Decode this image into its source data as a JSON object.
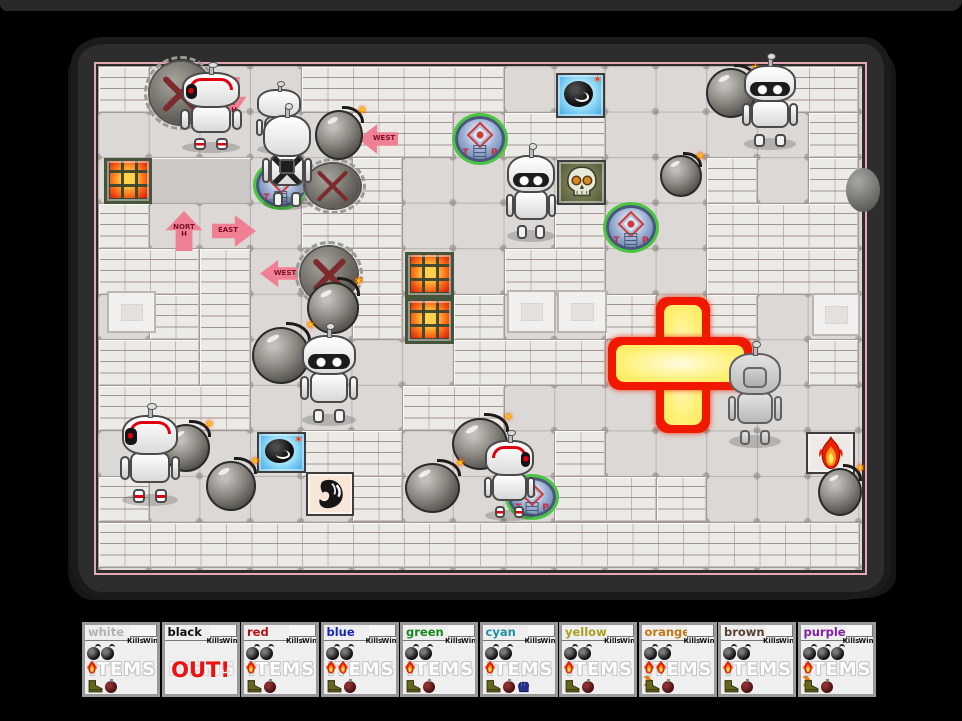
{
  "scoreboard": {
    "kills_label": "Kills",
    "wins_label": "Wins",
    "items_label": "ITEMS",
    "out_label": "OUT!",
    "players": [
      {
        "name": "white",
        "color": "#b2b2b2",
        "alive": true,
        "bombs": 2,
        "flames": 1,
        "arrow": false,
        "glove": false
      },
      {
        "name": "black",
        "color": "#101010",
        "alive": false,
        "bombs": 0,
        "flames": 0,
        "arrow": false,
        "glove": false
      },
      {
        "name": "red",
        "color": "#b61010",
        "alive": true,
        "bombs": 2,
        "flames": 1,
        "arrow": false,
        "glove": false
      },
      {
        "name": "blue",
        "color": "#1a28b8",
        "alive": true,
        "bombs": 2,
        "flames": 2,
        "arrow": false,
        "glove": false
      },
      {
        "name": "green",
        "color": "#18871f",
        "alive": true,
        "bombs": 2,
        "flames": 1,
        "arrow": false,
        "glove": false
      },
      {
        "name": "cyan",
        "color": "#2090a8",
        "alive": true,
        "bombs": 2,
        "flames": 1,
        "arrow": false,
        "glove": true
      },
      {
        "name": "yellow",
        "color": "#a8a020",
        "alive": true,
        "bombs": 2,
        "flames": 1,
        "arrow": false,
        "glove": false
      },
      {
        "name": "orange",
        "color": "#c07818",
        "alive": true,
        "bombs": 2,
        "flames": 2,
        "arrow": true,
        "glove": false
      },
      {
        "name": "brown",
        "color": "#5a4030",
        "alive": true,
        "bombs": 2,
        "flames": 1,
        "arrow": false,
        "glove": false
      },
      {
        "name": "purple",
        "color": "#8020a0",
        "alive": true,
        "bombs": 3,
        "flames": 1,
        "arrow": true,
        "glove": false
      }
    ]
  },
  "arena": {
    "colors": {
      "background": "#000000",
      "frame": "#2d2d2d",
      "border_line": "#e2a9b3",
      "floor": "#dbd8d5",
      "wall": "#eceae7",
      "explosion_rim": "#f01800",
      "explosion_core": "#fff176",
      "teleporter": "#8fa7cc",
      "arrow": "#ef8093",
      "lava": "#ff7a1a",
      "accent_red": "#e00010"
    },
    "grid": {
      "tile_w": 50.7,
      "tile_h": 45.55,
      "cols": 15,
      "rows": 11
    },
    "icons": {
      "spark": "✶"
    },
    "teleporter_letters": {
      "left": "T",
      "right": "P"
    },
    "walls": [
      {
        "c": 0,
        "r": 0,
        "w": 1,
        "h": 1
      },
      {
        "c": 4,
        "r": 0,
        "w": 4,
        "h": 1
      },
      {
        "c": 13,
        "r": 0,
        "w": 2,
        "h": 1
      },
      {
        "c": 5,
        "r": 1,
        "w": 2,
        "h": 1
      },
      {
        "c": 8,
        "r": 1,
        "w": 2,
        "h": 1
      },
      {
        "c": 14,
        "r": 1,
        "w": 1,
        "h": 1
      },
      {
        "c": 1,
        "r": 2,
        "w": 2,
        "h": 1,
        "v": "flat"
      },
      {
        "c": 5,
        "r": 2,
        "w": 1,
        "h": 1
      },
      {
        "c": 12,
        "r": 2,
        "w": 1,
        "h": 1
      },
      {
        "c": 14,
        "r": 2,
        "w": 1,
        "h": 1
      },
      {
        "c": 0,
        "r": 3,
        "w": 1,
        "h": 1
      },
      {
        "c": 4,
        "r": 3,
        "w": 2,
        "h": 1
      },
      {
        "c": 9,
        "r": 3,
        "w": 1,
        "h": 1
      },
      {
        "c": 12,
        "r": 3,
        "w": 3,
        "h": 1
      },
      {
        "c": 0,
        "r": 4,
        "w": 2,
        "h": 1
      },
      {
        "c": 2,
        "r": 4,
        "w": 1,
        "h": 3
      },
      {
        "c": 5,
        "r": 4,
        "w": 1,
        "h": 1
      },
      {
        "c": 8,
        "r": 4,
        "w": 2,
        "h": 1
      },
      {
        "c": 12,
        "r": 4,
        "w": 3,
        "h": 1
      },
      {
        "c": 1,
        "r": 5,
        "w": 1,
        "h": 1
      },
      {
        "c": 5,
        "r": 5,
        "w": 1,
        "h": 1
      },
      {
        "c": 7,
        "r": 5,
        "w": 1,
        "h": 1
      },
      {
        "c": 10,
        "r": 5,
        "w": 1,
        "h": 1
      },
      {
        "c": 12,
        "r": 5,
        "w": 1,
        "h": 1
      },
      {
        "c": 0,
        "r": 6,
        "w": 2,
        "h": 1
      },
      {
        "c": 7,
        "r": 6,
        "w": 3,
        "h": 1
      },
      {
        "c": 14,
        "r": 6,
        "w": 1,
        "h": 1
      },
      {
        "c": 0,
        "r": 7,
        "w": 3,
        "h": 1
      },
      {
        "c": 6,
        "r": 7,
        "w": 2,
        "h": 1
      },
      {
        "c": 4,
        "r": 8,
        "w": 2,
        "h": 1
      },
      {
        "c": 9,
        "r": 8,
        "w": 1,
        "h": 1
      },
      {
        "c": 0,
        "r": 9,
        "w": 1,
        "h": 1
      },
      {
        "c": 5,
        "r": 9,
        "w": 1,
        "h": 1
      },
      {
        "c": 9,
        "r": 9,
        "w": 2,
        "h": 1
      },
      {
        "c": 11,
        "r": 9,
        "w": 1,
        "h": 1
      },
      {
        "c": 0,
        "r": 10,
        "w": 15,
        "h": 1
      }
    ],
    "plates": [
      {
        "x": 9,
        "y": 225,
        "w": 49,
        "h": 42
      },
      {
        "x": 409,
        "y": 224,
        "w": 49,
        "h": 43
      },
      {
        "x": 459,
        "y": 224,
        "w": 50,
        "h": 43
      },
      {
        "x": 714,
        "y": 227,
        "w": 48,
        "h": 43
      }
    ],
    "items": [
      {
        "type": "lava-grate",
        "x": 6,
        "y": 92,
        "w": 48,
        "h": 46
      },
      {
        "type": "lava-grate",
        "x": 307,
        "y": 186,
        "w": 49,
        "h": 46
      },
      {
        "type": "lava-grate",
        "x": 307,
        "y": 232,
        "w": 49,
        "h": 46
      },
      {
        "type": "bomb-item-tile",
        "x": 458,
        "y": 7,
        "w": 49,
        "h": 45
      },
      {
        "type": "skull-item-tile",
        "x": 459,
        "y": 94,
        "w": 49,
        "h": 45
      },
      {
        "type": "bomb-item-tile",
        "x": 159,
        "y": 366,
        "w": 49,
        "h": 41
      },
      {
        "type": "swirl-item-tile",
        "x": 208,
        "y": 406,
        "w": 48,
        "h": 44
      },
      {
        "type": "flame-item-tile",
        "x": 708,
        "y": 366,
        "w": 49,
        "h": 42
      }
    ],
    "teleporters": [
      {
        "x": 158,
        "y": 97,
        "w": 50,
        "h": 44
      },
      {
        "x": 357,
        "y": 50,
        "w": 50,
        "h": 46
      },
      {
        "x": 508,
        "y": 139,
        "w": 50,
        "h": 45
      },
      {
        "x": 410,
        "y": 411,
        "w": 48,
        "h": 40
      }
    ],
    "arrows": [
      {
        "dir": "down",
        "label": "SOUTH",
        "x": 122,
        "y": 11,
        "w": 28,
        "h": 38
      },
      {
        "dir": "left",
        "label": "WEST",
        "x": 260,
        "y": 56,
        "w": 40,
        "h": 34
      },
      {
        "dir": "up",
        "label": "NORTH",
        "x": 65,
        "y": 145,
        "w": 42,
        "h": 40
      },
      {
        "dir": "right",
        "label": "EAST",
        "x": 114,
        "y": 147,
        "w": 44,
        "h": 36
      },
      {
        "dir": "left",
        "label": "WEST",
        "x": 162,
        "y": 192,
        "w": 38,
        "h": 31
      }
    ],
    "mines": [
      {
        "x": 52,
        "y": -4,
        "w": 62,
        "h": 62
      },
      {
        "x": 208,
        "y": 98,
        "w": 54,
        "h": 44
      },
      {
        "x": 203,
        "y": 181,
        "w": 56,
        "h": 55
      }
    ],
    "bombs": [
      {
        "x": 217,
        "y": 44,
        "w": 48,
        "h": 50
      },
      {
        "x": 562,
        "y": 89,
        "w": 42,
        "h": 42
      },
      {
        "x": 608,
        "y": 2,
        "w": 50,
        "h": 50
      },
      {
        "x": 64,
        "y": 358,
        "w": 48,
        "h": 48
      },
      {
        "x": 108,
        "y": 395,
        "w": 50,
        "h": 50
      },
      {
        "x": 209,
        "y": 216,
        "w": 52,
        "h": 52
      },
      {
        "x": 154,
        "y": 261,
        "w": 58,
        "h": 57
      },
      {
        "x": 354,
        "y": 352,
        "w": 56,
        "h": 52
      },
      {
        "x": 307,
        "y": 397,
        "w": 55,
        "h": 50
      },
      {
        "x": 720,
        "y": 402,
        "w": 44,
        "h": 48
      }
    ],
    "robots": [
      {
        "variant": "side-left",
        "x": 80,
        "y": 2,
        "w": 66,
        "h": 85
      },
      {
        "variant": "back",
        "x": 156,
        "y": 20,
        "w": 50,
        "h": 68
      },
      {
        "variant": "backpack",
        "x": 162,
        "y": 44,
        "w": 54,
        "h": 100
      },
      {
        "variant": "front",
        "x": 406,
        "y": 84,
        "w": 54,
        "h": 92
      },
      {
        "variant": "front",
        "x": 642,
        "y": -6,
        "w": 60,
        "h": 90
      },
      {
        "variant": "front",
        "x": 200,
        "y": 264,
        "w": 62,
        "h": 96
      },
      {
        "variant": "gray",
        "x": 628,
        "y": 282,
        "w": 58,
        "h": 100
      },
      {
        "variant": "side-left",
        "x": 20,
        "y": 344,
        "w": 64,
        "h": 96
      },
      {
        "variant": "side-right",
        "x": 384,
        "y": 370,
        "w": 55,
        "h": 85
      }
    ],
    "explosion": {
      "vertical": {
        "x": 558,
        "y": 231,
        "w": 54,
        "h": 136
      },
      "horizontal": {
        "x": 510,
        "y": 271,
        "w": 144,
        "h": 53
      }
    },
    "border_rock": {
      "x": 748,
      "y": 102,
      "w": 34,
      "h": 44
    }
  }
}
